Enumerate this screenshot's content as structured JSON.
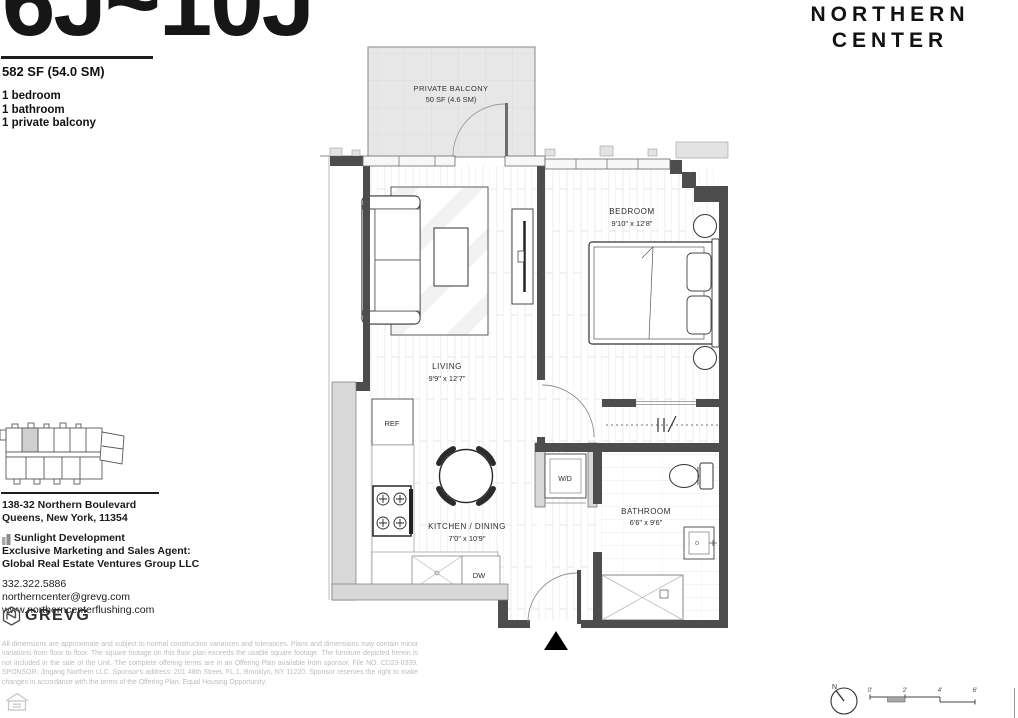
{
  "unit": {
    "title": "6J~10J",
    "area": "582 SF (54.0 SM)",
    "features": [
      "1 bedroom",
      "1 bathroom",
      "1 private balcony"
    ]
  },
  "building": {
    "name_line1": "NORTHERN",
    "name_line2": "CENTER"
  },
  "floorplan": {
    "balcony": {
      "name": "PRIVATE BALCONY",
      "area": "50 SF (4.6 SM)"
    },
    "bedroom": {
      "name": "BEDROOM",
      "dims": "9'10\" x 12'8\""
    },
    "living": {
      "name": "LIVING",
      "dims": "9'9\" x 12'7\""
    },
    "kitchen": {
      "name": "KITCHEN / DINING",
      "dims": "7'0\" x 10'9\""
    },
    "bathroom": {
      "name": "BATHROOM",
      "dims": "6'6\" x 9'6\""
    },
    "labels": {
      "wd": "W/D",
      "ref": "REF",
      "dw": "DW"
    }
  },
  "contact": {
    "address_line1": "138-32 Northern Boulevard",
    "address_line2": "Queens, New York, 11354",
    "developer": "Sunlight Development",
    "agent_label": "Exclusive Marketing and Sales Agent:",
    "agent_name": "Global Real Estate Ventures Group LLC",
    "phone": "332.322.5886",
    "email": "northerncenter@grevg.com",
    "website": "www.northerncenterflushing.com",
    "brand": "GREVG"
  },
  "legal": {
    "disclaimer": "All dimensions are approximate and subject to normal construction variances and tolerances. Plans and dimensions may contain minor variations from floor to floor. The square footage on this floor plan exceeds the usable square footage. The furniture depicted herein is not included in the sale of the Unit. The complete offering terms are in an Offering Plan available from sponsor, File NO. CD23-0339. SPONSOR: Jingang Northern LLC. Sponsor's address: 201 48th Street, FL 1, Brooklyn, NY 11220. Sponsor reserves the right to make changes in accordance with the terms of the Offering Plan. Equal Housing Opportunity."
  },
  "scale": {
    "compass_label": "N",
    "ticks": [
      "0'",
      "2'",
      "4'",
      "6'"
    ]
  },
  "colors": {
    "wall_dark": "#4d4d4d",
    "wall_light": "#d8d8d8",
    "balcony_fill": "#e7e7e7",
    "text_dark": "#1d1d1d",
    "muted_text": "#bdbdbd"
  }
}
